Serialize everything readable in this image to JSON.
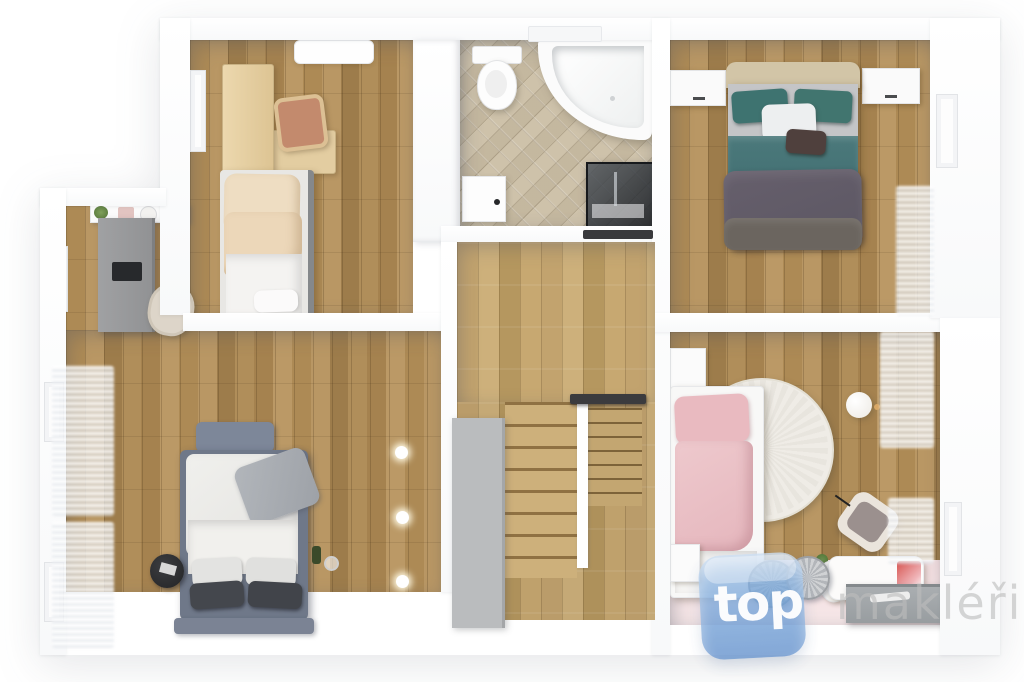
{
  "watermark": {
    "logo_text": "top",
    "brand_text": "makléři",
    "logo_color": "#7aa7da",
    "brand_text_color": "#bdbdbd"
  },
  "palette": {
    "wall_white": "#ffffff",
    "wood_floor": "#ab8a57",
    "stairs_wood": "#c2a36e",
    "bathroom_tile": "#cfc3ad",
    "teal_bedding": "#3e7370",
    "dark_blanket": "#615c68",
    "pink_bedding": "#e9bac0",
    "kids_pink_floor": "#f3dee0",
    "gray_desk": "#98999b",
    "gray_lower_wall": "#babcbe",
    "headboard_blue_gray": "#7d8799",
    "railing_dark": "#39393c"
  },
  "scene": {
    "type": "floor-plan-3d-render",
    "floor": "upper-floor",
    "rooms": [
      {
        "name": "study-bedroom-top-left",
        "furniture": [
          "wood-desk",
          "desk-chair",
          "single-bed-beige",
          "ceiling-vent",
          "door"
        ]
      },
      {
        "name": "bathroom",
        "furniture": [
          "toilet",
          "corner-bathtub",
          "shower-cabin",
          "cabinet",
          "wall-shelf"
        ]
      },
      {
        "name": "master-bedroom-top-right",
        "furniture": [
          "double-bed-teal",
          "nightstand-left",
          "nightstand-right",
          "door",
          "window-curtains"
        ]
      },
      {
        "name": "kids-room-bottom-right",
        "furniture": [
          "white-bed-pink-bedding",
          "round-rug",
          "armchair",
          "ball-lamp",
          "kids-table",
          "kids-chair",
          "storage-box",
          "basket-blue",
          "basket-gray",
          "pink-floor-mat",
          "window-curtains"
        ]
      },
      {
        "name": "bedroom-bottom-left",
        "furniture": [
          "double-bed-white",
          "headboard",
          "black-side-table",
          "gray-desk",
          "laptop",
          "office-chair",
          "wall-shelf",
          "plant",
          "wine-bottle",
          "downlights",
          "window-curtains",
          "door"
        ]
      },
      {
        "name": "hall-staircase",
        "furniture": [
          "landing",
          "stair-flight-left",
          "stair-flight-right",
          "divider-wall",
          "railing-upper",
          "railing-lower",
          "gray-lower-wall"
        ]
      }
    ]
  }
}
